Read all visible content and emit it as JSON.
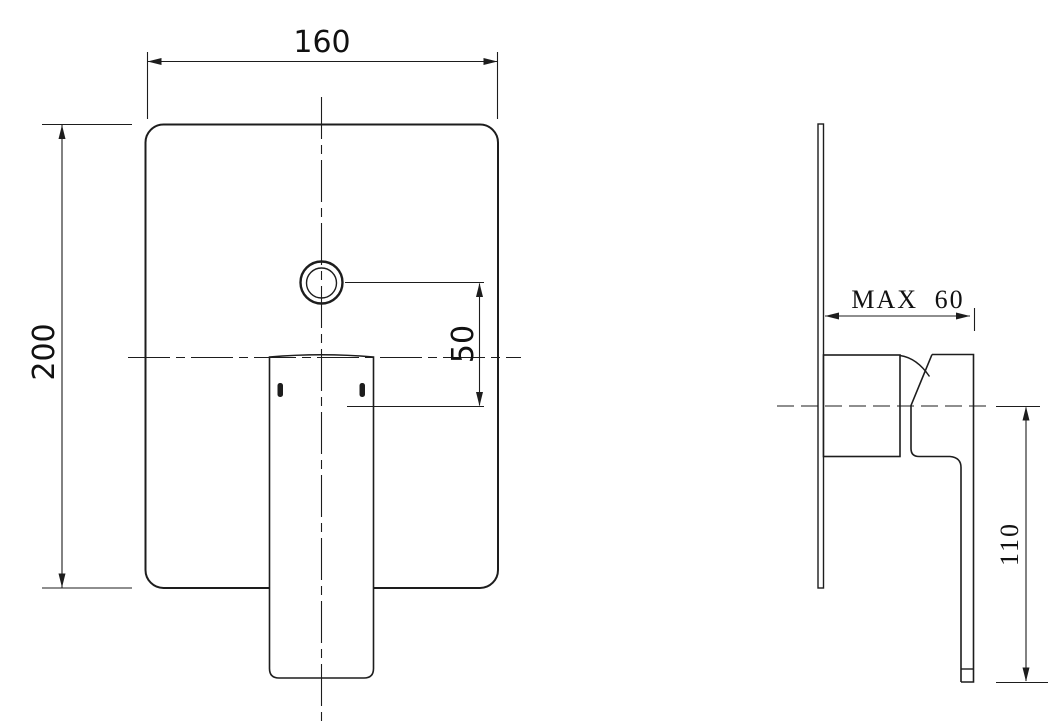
{
  "front_view": {
    "width_label": "160",
    "height_label": "200",
    "hole_offset_label": "50"
  },
  "side_view": {
    "depth_label": "MAX 60",
    "handle_length_label": "110"
  },
  "colors": {
    "background": "#ffffff",
    "line": "#1d1d1d"
  }
}
